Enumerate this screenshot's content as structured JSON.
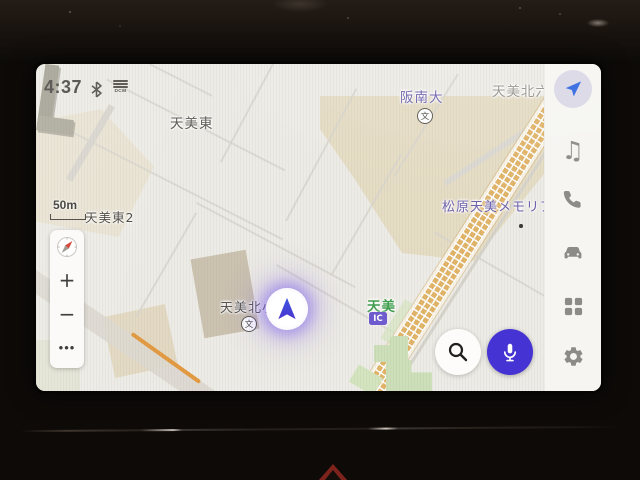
{
  "status": {
    "time": "4:37",
    "dcm_label": "DCM",
    "icons": [
      "bluetooth-icon",
      "dcm-signal-icon"
    ]
  },
  "map": {
    "scale_label": "50m",
    "labels": {
      "district_northeast": "天美北六",
      "university": "阪南大",
      "district_west": "天美東",
      "district_west_block": "天美東2",
      "memorial_hall": "松原天美メモリア",
      "elementary_school": "天美北小",
      "interchange_name": "天美",
      "interchange_badge": "IC",
      "school_map_symbol": "文"
    },
    "controls": {
      "zoom_in_label": "+",
      "zoom_out_label": "−",
      "more_label": "•••",
      "compass_icon": "compass-icon"
    },
    "colors": {
      "mic_button": "#4633d4",
      "position_marker": "#4640d6",
      "construction_band": "#e9c47f",
      "orange_road": "#e39a41",
      "park_green": "#ccdfb8",
      "label_purple": "#6f63ae",
      "label_green": "#3f9e4d"
    }
  },
  "floating_buttons": {
    "search_icon": "magnifier-icon",
    "voice_icon": "microphone-icon"
  },
  "sidebar": {
    "music_glyph": "♫",
    "icons": [
      {
        "name": "navigation-arrow-icon",
        "active": true
      },
      {
        "name": "music-note-icon",
        "active": false
      },
      {
        "name": "phone-icon",
        "active": false
      },
      {
        "name": "car-icon",
        "active": false
      },
      {
        "name": "apps-grid-icon",
        "active": false
      },
      {
        "name": "settings-gear-icon",
        "active": false
      }
    ]
  },
  "bezel": {
    "hazard_icon": "hazard-warning-triangle"
  }
}
